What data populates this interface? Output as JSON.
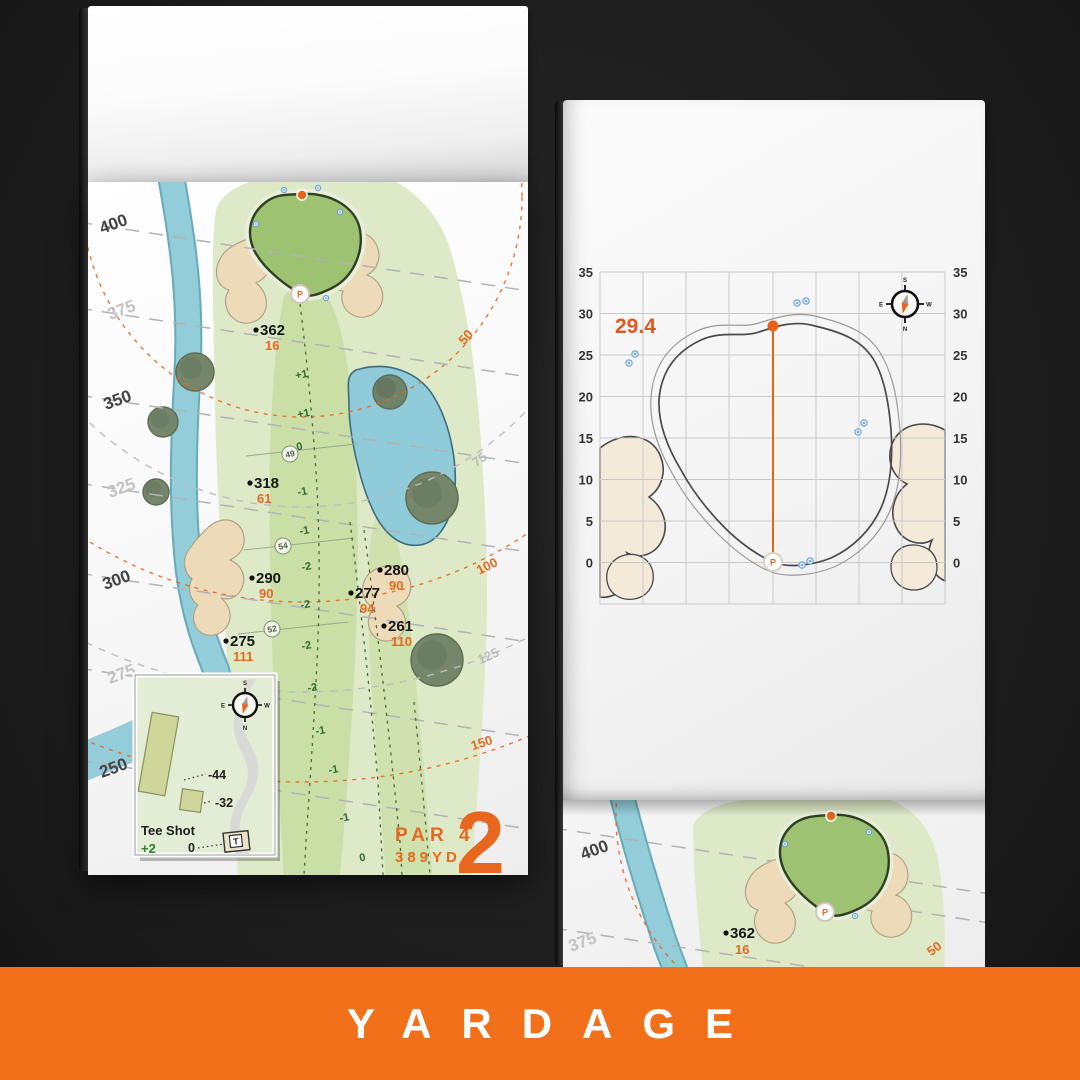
{
  "banner": {
    "label": "YARDAGE",
    "bg_color": "#F3701A"
  },
  "colors": {
    "accent_orange": "#E8671F",
    "water_blue": "#8FCBD9",
    "sand": "#ECDAB8",
    "green_fill": "#9CC272",
    "fairway": "#CBDFA9",
    "rough": "#DCE9C6"
  },
  "hole_page": {
    "hole_number": "2",
    "par_label": "PAR 4",
    "distance_label": "389YD",
    "margin_yardages": [
      "400",
      "375",
      "350",
      "325",
      "300",
      "275",
      "250"
    ],
    "arc_labels": [
      "50",
      "75",
      "100",
      "125",
      "150"
    ],
    "pin_label": "P",
    "markers": [
      {
        "carry": "362",
        "front": "16"
      },
      {
        "carry": "318",
        "front": "61"
      },
      {
        "carry": "290",
        "front": "90"
      },
      {
        "carry": "280",
        "front": "90"
      },
      {
        "carry": "277",
        "front": "94"
      },
      {
        "carry": "261",
        "front": "110"
      },
      {
        "carry": "275",
        "front": "111"
      }
    ],
    "fairway_widths": [
      "49",
      "54",
      "52"
    ],
    "slopes": [
      "+1",
      "+1",
      "0",
      "-1",
      "-1",
      "-2",
      "-2",
      "-2",
      "-2",
      "-1",
      "-1",
      "-1",
      "0"
    ],
    "tee_inset": {
      "title": "Tee Shot",
      "score": "+2",
      "carry_long": "-44",
      "carry_short": "-32",
      "zero": "0",
      "tee_label": "T"
    },
    "compass": {
      "n": "N",
      "s": "S",
      "e": "E",
      "w": "W"
    }
  },
  "green_page": {
    "depth_label": "29.4",
    "pin_label": "P",
    "y_ticks": [
      "35",
      "30",
      "25",
      "20",
      "15",
      "10",
      "5",
      "0"
    ],
    "compass": {
      "n": "N",
      "s": "S",
      "e": "E",
      "w": "W"
    }
  },
  "next_page": {
    "margin_yardages": [
      "400",
      "375"
    ],
    "arc_label": "50",
    "marker": {
      "carry": "362",
      "front": "16"
    },
    "pin_label": "P"
  },
  "chart_data": {
    "type": "line",
    "title": "Green depth grid",
    "ylabel": "yards",
    "ylim": [
      0,
      35
    ],
    "y_ticks": [
      0,
      5,
      10,
      15,
      20,
      25,
      30,
      35
    ],
    "grid": true,
    "series": [
      {
        "name": "pin-to-selected-point-depth",
        "values": [
          29.4
        ]
      }
    ],
    "annotations": [
      "29.4"
    ]
  }
}
